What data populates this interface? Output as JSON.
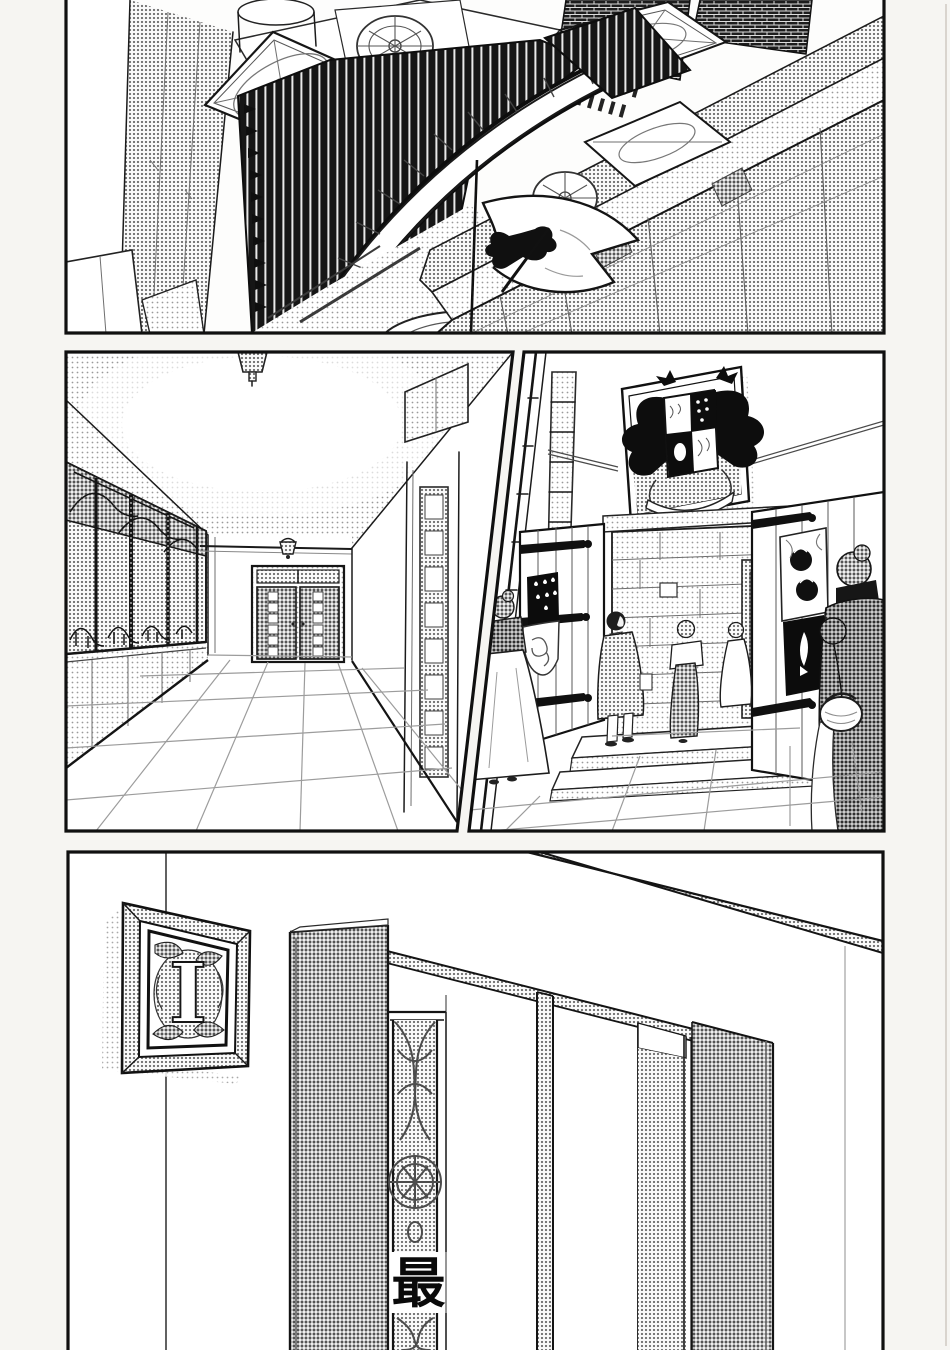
{
  "page": {
    "background": "#f6f5f2",
    "panel_fill": "#fdfdfc",
    "ink": "#141414"
  },
  "texts": {
    "caption_char": "最",
    "plaque_letter": "I"
  },
  "palette": {
    "halftone_light": "#e2e2e0",
    "halftone_mid": "#c4c4c2",
    "halftone_dark": "#9e9e9c",
    "black_ink": "#141414"
  },
  "panels": [
    {
      "name": "aerial-academy-exterior"
    },
    {
      "name": "corridor-interior"
    },
    {
      "name": "entrance-hall-with-figures"
    },
    {
      "name": "corridor-wall-letter-plaque"
    }
  ]
}
